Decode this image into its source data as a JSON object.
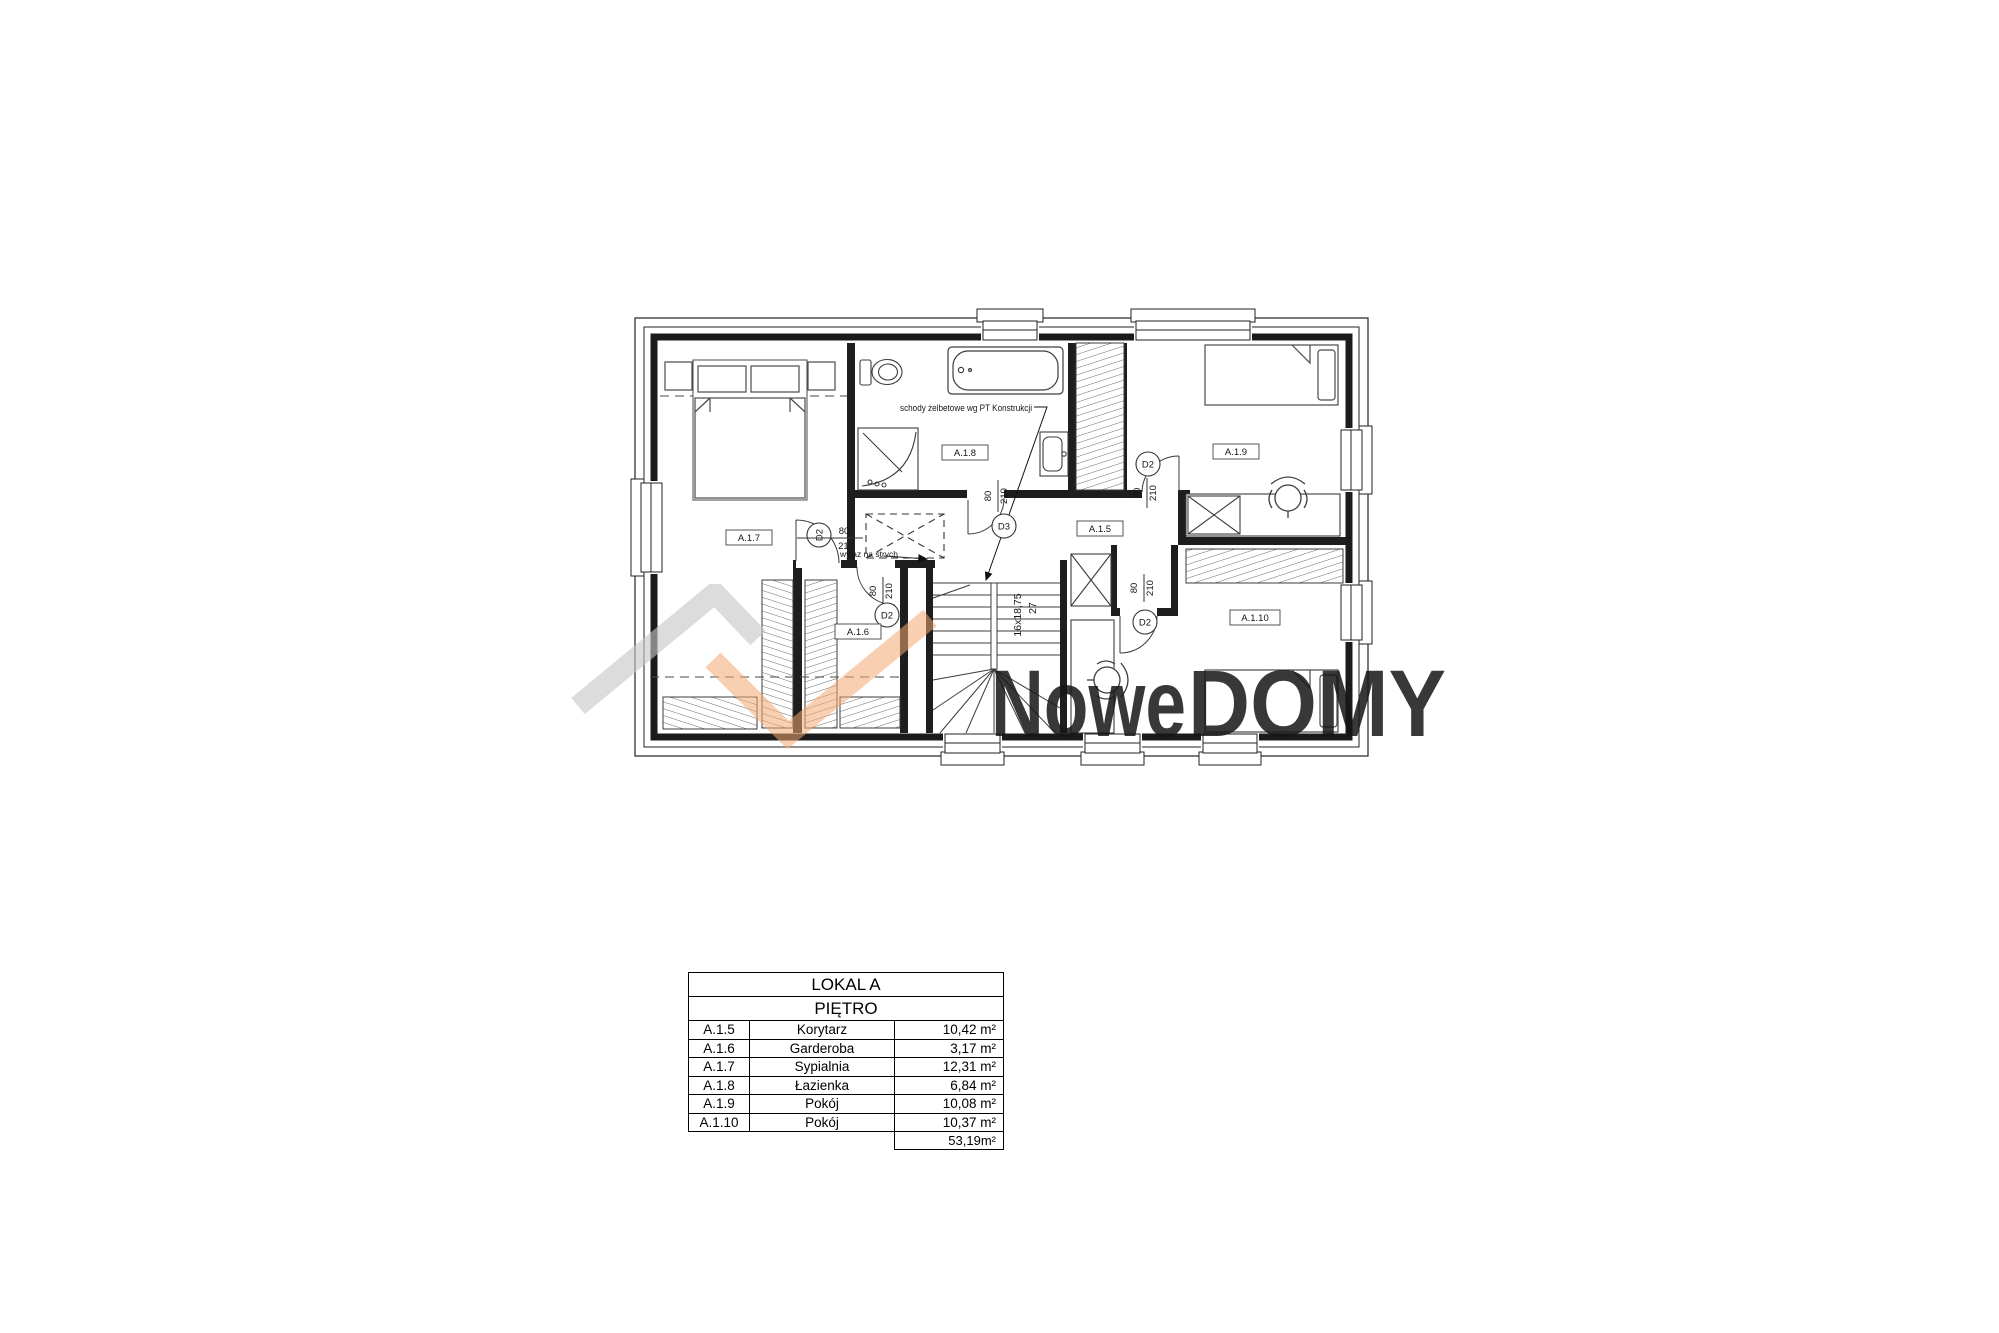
{
  "plan": {
    "rooms": [
      {
        "id": "A.1.7"
      },
      {
        "id": "A.1.8"
      },
      {
        "id": "A.1.5"
      },
      {
        "id": "A.1.9"
      },
      {
        "id": "A.1.6"
      },
      {
        "id": "A.1.10"
      }
    ],
    "doors": [
      {
        "label": "D2",
        "w": "80",
        "h": "210"
      },
      {
        "label": "D3",
        "w": "80",
        "h": "210"
      },
      {
        "label": "D2",
        "w": "80",
        "h": "210"
      },
      {
        "label": "D2",
        "w": "80",
        "h": "210"
      },
      {
        "label": "D2",
        "w": "80",
        "h": "210"
      }
    ],
    "annotations": {
      "stairs_note": "schody żelbetowe wg PT Konstrukcji",
      "attic_hatch": "wyłaz na strych",
      "stair_dim_run": "16x18,75",
      "stair_dim_width": "27"
    }
  },
  "watermark": {
    "gray_text": "Nowe",
    "orange_text": "DOMY",
    "gray_color": "#c6c6c6",
    "orange_color": "#f4a873"
  },
  "table": {
    "title": "LOKAL A",
    "subtitle": "PIĘTRO",
    "rows": [
      {
        "code": "A.1.5",
        "name": "Korytarz",
        "area": "10,42 m²"
      },
      {
        "code": "A.1.6",
        "name": "Garderoba",
        "area": "3,17 m²"
      },
      {
        "code": "A.1.7",
        "name": "Sypialnia",
        "area": "12,31 m²"
      },
      {
        "code": "A.1.8",
        "name": "Łazienka",
        "area": "6,84 m²"
      },
      {
        "code": "A.1.9",
        "name": "Pokój",
        "area": "10,08 m²"
      },
      {
        "code": "A.1.10",
        "name": "Pokój",
        "area": "10,37 m²"
      }
    ],
    "total": "53,19m²"
  }
}
